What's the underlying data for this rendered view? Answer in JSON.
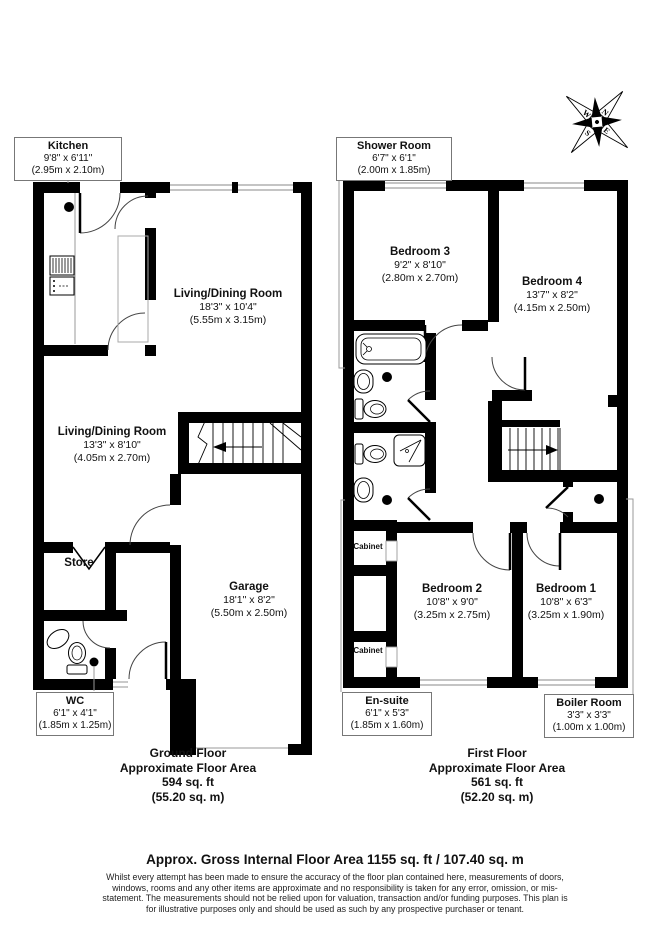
{
  "compass": {
    "n": "N",
    "e": "E",
    "s": "S",
    "w": "W"
  },
  "ground_floor": {
    "caption": {
      "line1": "Ground Floor",
      "line2": "Approximate Floor Area",
      "line3": "594 sq. ft",
      "line4": "(55.20 sq. m)"
    },
    "kitchen": {
      "name": "Kitchen",
      "imperial": "9'8\" x 6'11\"",
      "metric": "(2.95m x 2.10m)"
    },
    "living_dining_upper": {
      "name": "Living/Dining Room",
      "imperial": "18'3\" x 10'4\"",
      "metric": "(5.55m x 3.15m)"
    },
    "living_dining_lower": {
      "name": "Living/Dining Room",
      "imperial": "13'3\" x 8'10\"",
      "metric": "(4.05m x 2.70m)"
    },
    "store": {
      "name": "Store"
    },
    "wc": {
      "name": "WC",
      "imperial": "6'1\" x 4'1\"",
      "metric": "(1.85m x 1.25m)"
    },
    "garage": {
      "name": "Garage",
      "imperial": "18'1\" x 8'2\"",
      "metric": "(5.50m x 2.50m)"
    }
  },
  "first_floor": {
    "caption": {
      "line1": "First Floor",
      "line2": "Approximate Floor Area",
      "line3": "561 sq. ft",
      "line4": "(52.20 sq. m)"
    },
    "shower_room": {
      "name": "Shower Room",
      "imperial": "6'7\" x 6'1\"",
      "metric": "(2.00m x 1.85m)"
    },
    "bedroom3": {
      "name": "Bedroom 3",
      "imperial": "9'2\" x 8'10\"",
      "metric": "(2.80m x 2.70m)"
    },
    "bedroom4": {
      "name": "Bedroom 4",
      "imperial": "13'7\" x 8'2\"",
      "metric": "(4.15m x 2.50m)"
    },
    "bedroom2": {
      "name": "Bedroom 2",
      "imperial": "10'8\" x 9'0\"",
      "metric": "(3.25m x 2.75m)"
    },
    "bedroom1": {
      "name": "Bedroom 1",
      "imperial": "10'8\" x 6'3\"",
      "metric": "(3.25m x 1.90m)"
    },
    "en_suite": {
      "name": "En-suite",
      "imperial": "6'1\" x 5'3\"",
      "metric": "(1.85m x 1.60m)"
    },
    "boiler_room": {
      "name": "Boiler Room",
      "imperial": "3'3\" x 3'3\"",
      "metric": "(1.00m x 1.00m)"
    },
    "cabinet_upper": {
      "name": "Cabinet"
    },
    "cabinet_lower": {
      "name": "Cabinet"
    }
  },
  "footer": {
    "title": "Approx. Gross Internal Floor Area 1155 sq. ft / 107.40 sq. m",
    "disclaimer": "Whilst every attempt has been made to ensure the accuracy of the floor plan contained here, measurements of doors, windows, rooms and any other items are approximate and no responsibility is taken for any error, omission, or mis-statement. The measurements should not be relied upon for valuation, transaction and/or funding purposes. This plan is for illustrative purposes only and should be used as such by any prospective purchaser or tenant."
  }
}
